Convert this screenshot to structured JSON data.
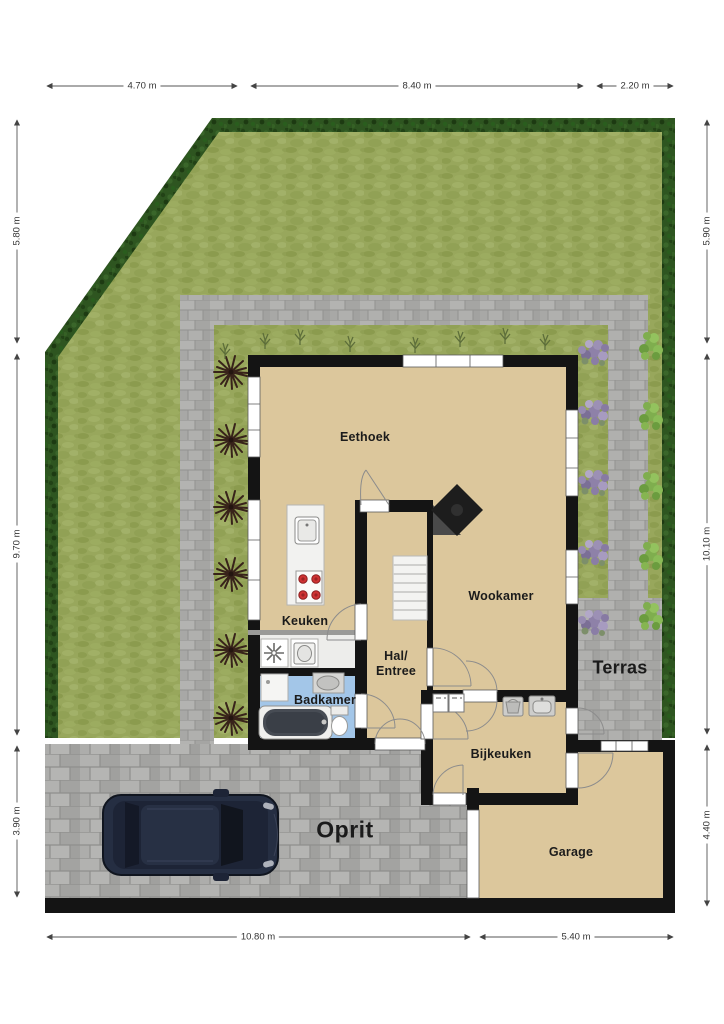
{
  "rooms": {
    "eethoek": "Eethoek",
    "keuken": "Keuken",
    "wookamer": "Wookamer",
    "hal_line1": "Hal/",
    "hal_line2": "Entree",
    "badkamer": "Badkamer",
    "bijkeuken": "Bijkeuken",
    "garage": "Garage"
  },
  "outdoor": {
    "terras": "Terras",
    "oprit": "Oprit"
  },
  "dimensions": {
    "top": [
      "4.70 m",
      "8.40 m",
      "2.20 m"
    ],
    "left": [
      "5.80 m",
      "9.70 m",
      "3.90 m"
    ],
    "right": [
      "5.90 m",
      "10.10 m",
      "4.40 m"
    ],
    "bottom": [
      "10.80 m",
      "5.40 m"
    ]
  },
  "colors": {
    "floor": "#dcc79c",
    "wall": "#141414",
    "grass": "#98a75c",
    "hedge": "#2e5520",
    "paving": "#ababa9",
    "bathroom_floor": "#a3c6e8",
    "stove_burner": "#cf3333",
    "car_body": "#252e42",
    "dimension_text": "#333333",
    "label_text": "#1b1b1b"
  },
  "icons": {
    "ventilation-icon": "asterisk-fan",
    "washbasin-icon": "oval-basin",
    "laundry-basket-icon": "basket",
    "sink-icon": "basin-with-tap",
    "stove-icon": "four-red-burners",
    "fireplace-icon": "rotated-square"
  }
}
